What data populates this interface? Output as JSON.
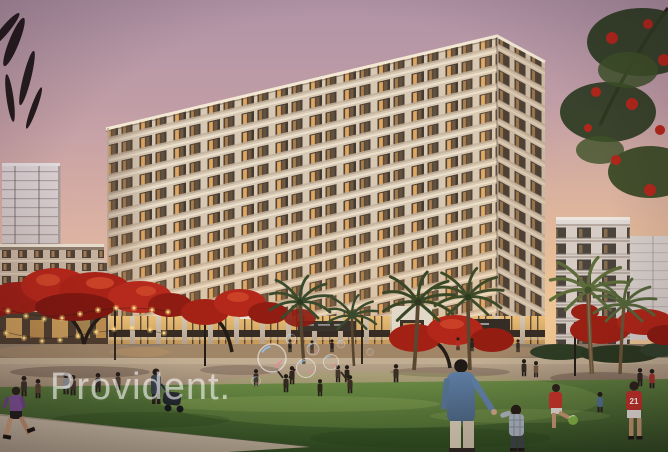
{
  "branding": {
    "watermark_text": "Provident."
  },
  "figures": {
    "jersey_number": "21"
  },
  "scene": {
    "type": "architectural-dusk-rendering",
    "description": "Residential apartment complex at dusk with lit balconies over a retail podium, fronted by a park lawn with palm trees, red flame trees, string lights, floating soap bubbles, strolling families and children playing football",
    "elements": [
      "sunset sky",
      "main apartment building",
      "distant white tower",
      "left low-rise block",
      "right mid-rise building",
      "retail storefronts",
      "entrance portal",
      "flame trees",
      "palm trees",
      "string lights",
      "promenade",
      "lawn",
      "walking path",
      "pedestrians",
      "children playing football",
      "father and child",
      "jogger",
      "stroller",
      "soap bubbles",
      "watermark"
    ]
  },
  "palette": {
    "sky_top": "#b093a6",
    "sky_mid": "#d8aea3",
    "sky_horizon": "#f2d4ac",
    "facade_cream": "#d7c8b4",
    "window_dark": "#43392f",
    "window_glow": "#f0b267",
    "flame_tree_red": "#b3261a",
    "palm_green": "#3a4a2c",
    "lawn_green": "#4e7030",
    "path_tan": "#b7ab97",
    "watermark_white": "#ffffff"
  }
}
